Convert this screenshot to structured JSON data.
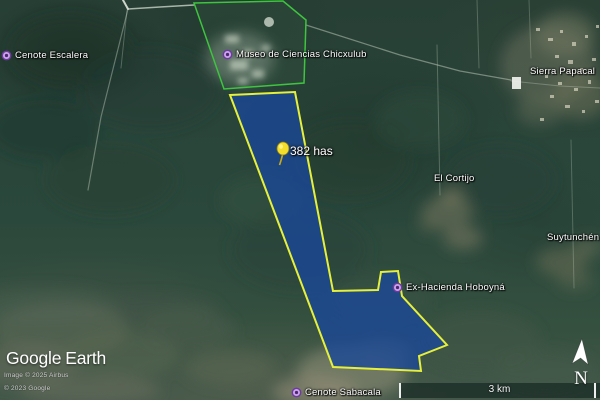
{
  "app_title": "Google Earth",
  "logo": {
    "google": "Google",
    "earth": "Earth"
  },
  "attribution": {
    "imagery_line": "Image © 2025 Airbus",
    "copyright_line": "© 2023 Google"
  },
  "scalebar": {
    "label": "3 km"
  },
  "compass": {
    "north_label": "N"
  },
  "parcel": {
    "area_label": "382 has",
    "fill_color": "#1a4899",
    "outline_color": "#e6f03a",
    "pin_color": "#f3df2b"
  },
  "museum_overlay": {
    "outline_color": "#3ec43e"
  },
  "marker_color": "#c9a2e8",
  "places": [
    {
      "name": "Cenote Escalera"
    },
    {
      "name": "Museo de Ciencias Chicxulub"
    },
    {
      "name": "Sierra Papacal"
    },
    {
      "name": "El Cortijo"
    },
    {
      "name": "Suytunchén"
    },
    {
      "name": "Ex-Hacienda Hoboyná"
    },
    {
      "name": "Cenote Sabacala"
    }
  ]
}
